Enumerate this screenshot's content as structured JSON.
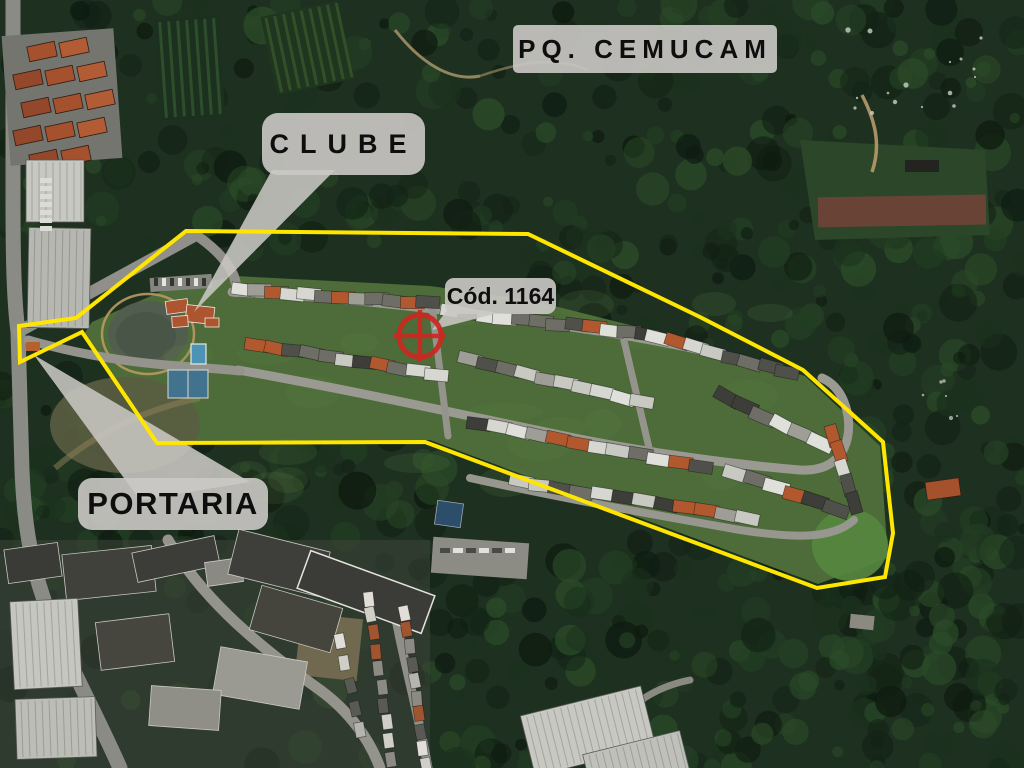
{
  "map": {
    "type": "satellite-aerial-photo",
    "labels": {
      "park": "PQ. CEMUCAM",
      "club": "CLUBE",
      "code": "Cód. 1164",
      "gate": "PORTARIA"
    },
    "overlay": {
      "boundary": {
        "color": "#ffe600",
        "points": "186,231 528,234 700,317 803,370 883,442 893,533 885,577 817,588 425,442 157,443 82,332 20,362 19,326 76,318"
      },
      "marker": {
        "color": "#cc2720",
        "transform": "translate(420,336)"
      }
    }
  }
}
